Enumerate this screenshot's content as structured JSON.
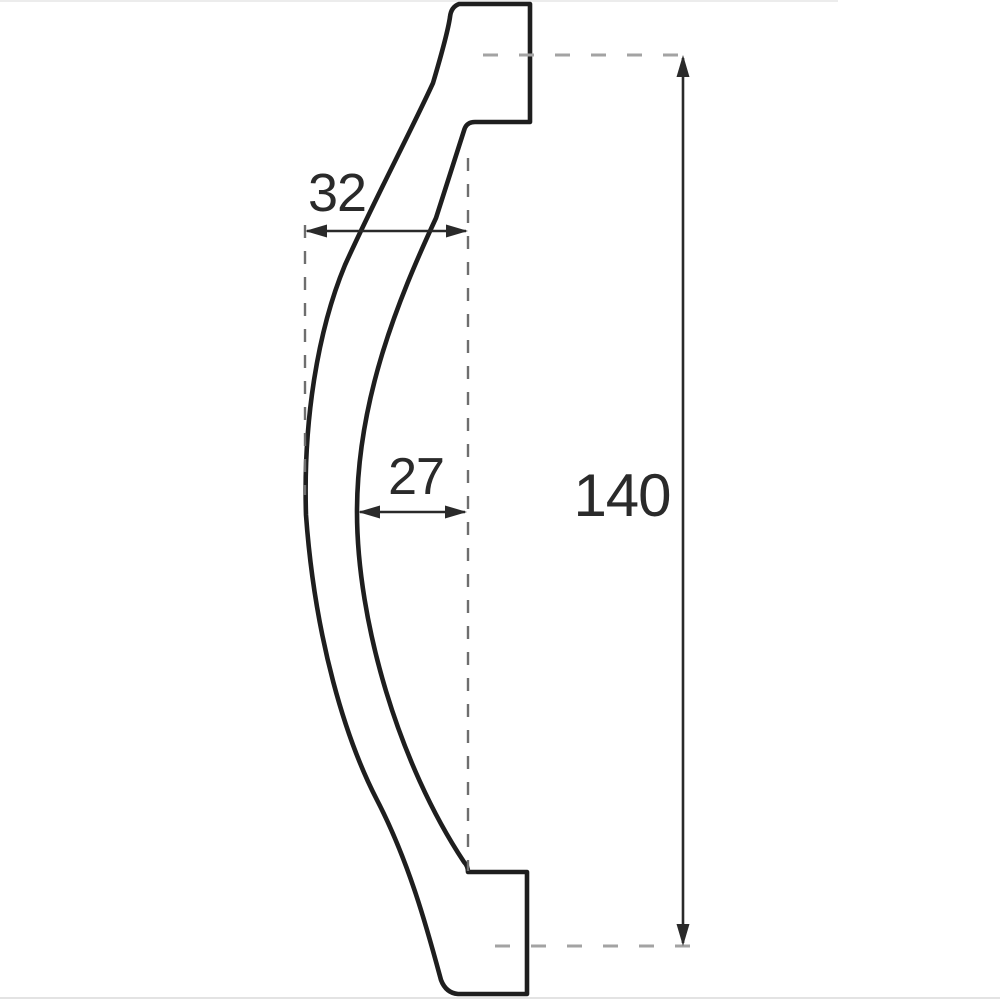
{
  "page": {
    "background": "#ffffff"
  },
  "diagram": {
    "type": "technical-drawing",
    "subject": "curved handle side profile with dimension callouts",
    "colors": {
      "outline": "#1e1e1e",
      "dimension": "#2a2a2a",
      "extension_dash": "#6e6e6e",
      "centerline_dash": "#a3a3a3"
    },
    "dimensions": {
      "upper_width": {
        "label": "32",
        "value": 32
      },
      "mid_width": {
        "label": "27",
        "value": 27
      },
      "overall_length": {
        "label": "140",
        "value": 140
      }
    }
  }
}
